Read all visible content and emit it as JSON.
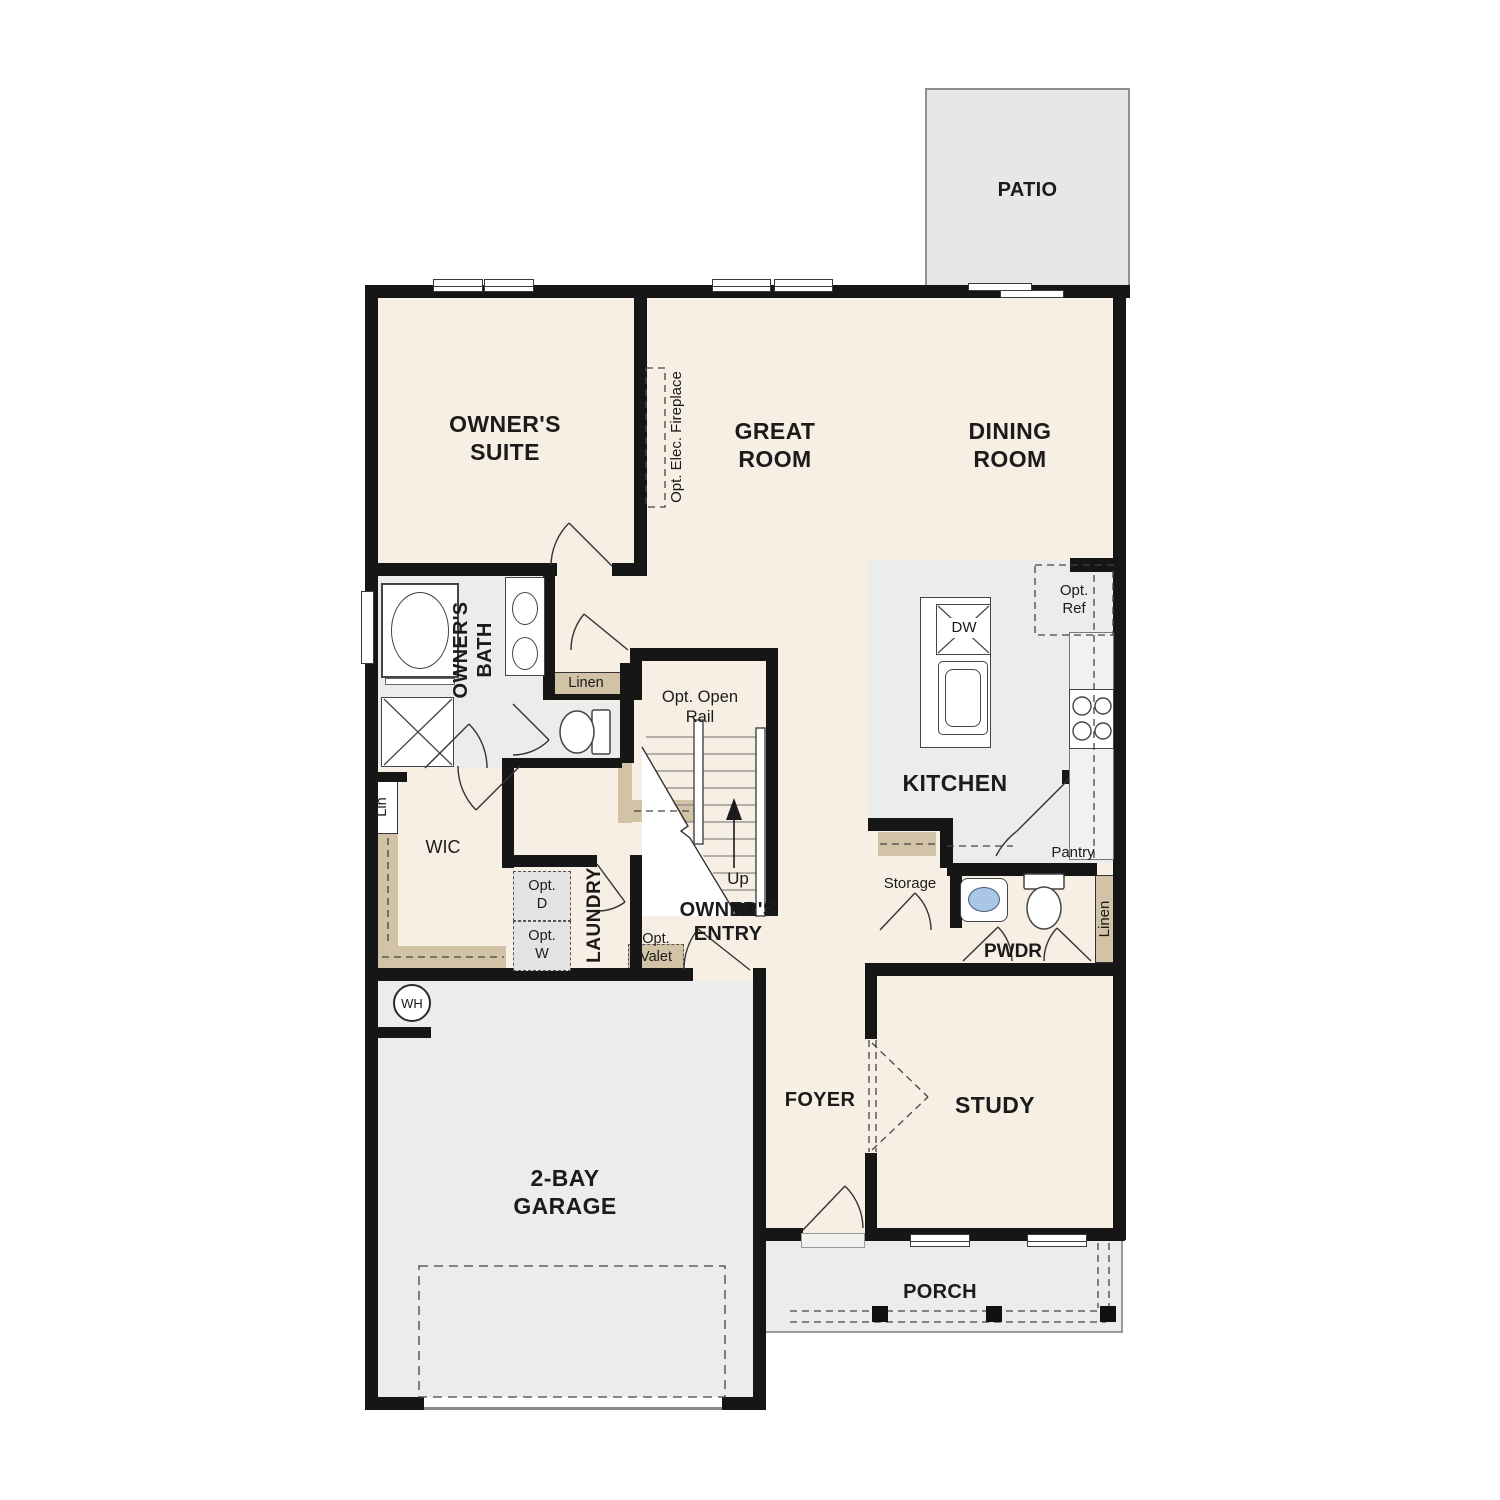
{
  "colors": {
    "floor_cream": "#f7efe4",
    "floor_gray": "#ececec",
    "patio_gray": "#e7e7e5",
    "shelf_tan": "#d2c3a7",
    "wall_black": "#161616",
    "sink_blue": "#a9c7e4"
  },
  "rooms": {
    "patio": "PATIO",
    "owners_suite": "OWNER'S\nSUITE",
    "great_room": "GREAT\nROOM",
    "dining_room": "DINING\nROOM",
    "kitchen": "KITCHEN",
    "owners_bath": "OWNER'S\nBATH",
    "wic": "WIC",
    "laundry": "LAUNDRY",
    "owners_entry": "OWNER'S\nENTRY",
    "storage": "Storage",
    "pwdr": "PWDR",
    "garage": "2-BAY\nGARAGE",
    "foyer": "FOYER",
    "study": "STUDY",
    "porch": "PORCH"
  },
  "features": {
    "opt_elec_fireplace": "Opt. Elec. Fireplace",
    "linen_bath": "Linen",
    "linen_pwdr": "Linen",
    "lin": "Lin",
    "opt_open_rail": "Opt. Open\nRail",
    "up": "Up",
    "dw": "DW",
    "opt_ref": "Opt.\nRef",
    "pantry": "Pantry",
    "opt_d": "Opt.\nD",
    "opt_w": "Opt.\nW",
    "opt_valet": "Opt.\nValet",
    "wh": "WH"
  }
}
